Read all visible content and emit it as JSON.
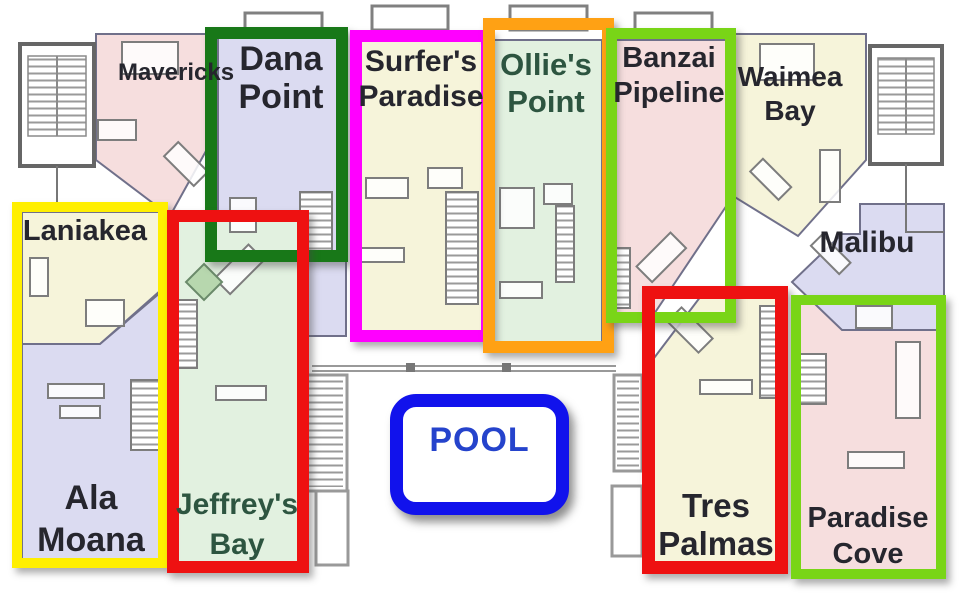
{
  "page": {
    "description": "Condominium floor plan with units named after surf breaks; selected units outlined with colored rectangles; pool badge in the courtyard"
  },
  "palette": {
    "pink": "#f6dede",
    "lavender": "#dbdbf1",
    "cream": "#f6f4da",
    "mint": "#e2f1e0",
    "label_dark": "#26262e",
    "label_green": "#2d5540",
    "pool_text_blue": "#2543cc",
    "plant_green": "#b7d7ae"
  },
  "highlights": {
    "yellow": {
      "color": "#ffef00",
      "units": [
        "Laniakea",
        "Ala Moana"
      ]
    },
    "dana": {
      "color": "#187818",
      "unit": "Dana Point"
    },
    "magenta": {
      "color": "#ff00ff",
      "unit": "Surfer's Paradise"
    },
    "orange": {
      "color": "#ffa114",
      "unit": "Ollie's Point"
    },
    "banzai": {
      "color": "#79d517",
      "unit": "Banzai Pipeline"
    },
    "jeffreys": {
      "color": "#ee1111",
      "unit": "Jeffrey's Bay"
    },
    "tres": {
      "color": "#ee1111",
      "unit": "Tres Palmas"
    },
    "paradise": {
      "color": "#79d517",
      "unit": "Paradise Cove"
    },
    "pool": {
      "border": "#1112ec",
      "fill": "#ffffff"
    }
  },
  "units": {
    "mavericks": {
      "name": "Mavericks"
    },
    "dana_point": {
      "name": "Dana\nPoint"
    },
    "surfers_paradise": {
      "name": "Surfer's\nParadise"
    },
    "ollies_point": {
      "name": "Ollie's\nPoint"
    },
    "banzai_pipeline": {
      "name": "Banzai\nPipeline"
    },
    "waimea_bay": {
      "name": "Waimea\nBay"
    },
    "malibu": {
      "name": "Malibu"
    },
    "laniakea": {
      "name": "Laniakea"
    },
    "ala_moana": {
      "name": "Ala\nMoana"
    },
    "jeffreys_bay": {
      "name": "Jeffrey's\nBay"
    },
    "tres_palmas": {
      "name": "Tres\nPalmas"
    },
    "paradise_cove": {
      "name": "Paradise\nCove"
    }
  },
  "pool": {
    "label": "POOL"
  }
}
